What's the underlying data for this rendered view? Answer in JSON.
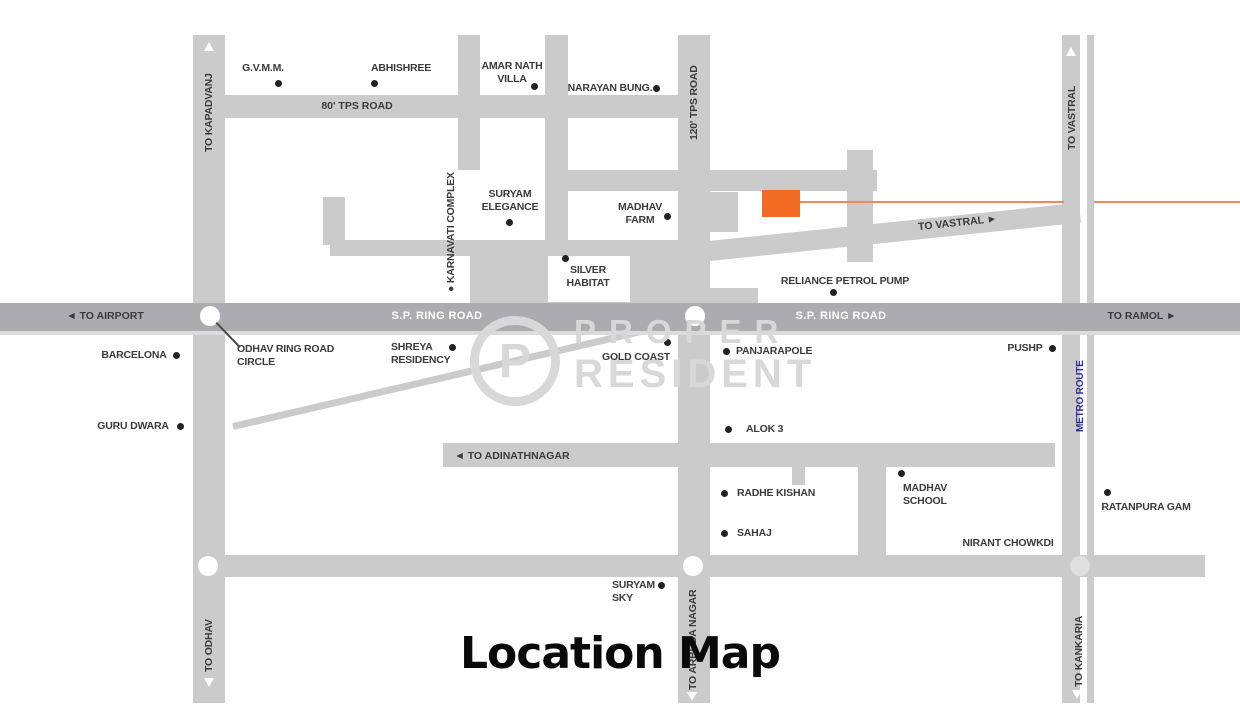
{
  "title": "Location Map",
  "watermark": {
    "logo": "P",
    "line1": "PROPER",
    "line2": "RESIDENT"
  },
  "colors": {
    "road": "#cbcbcb",
    "ring_road": "#acacb0",
    "marker_orange": "#f26b22",
    "line_orange": "#ee8a54",
    "metro_blue": "#2e3192",
    "label_dark": "#3b3b3b",
    "label_white": "#ffffff"
  },
  "road_labels": [
    {
      "id": "to-airport",
      "text": "◄ TO AIRPORT",
      "x": 105,
      "y": 316,
      "orient": "h",
      "color": "dark"
    },
    {
      "id": "sp-ring-road-left",
      "text": "S.P. RING ROAD",
      "x": 437,
      "y": 316,
      "orient": "h",
      "color": "white"
    },
    {
      "id": "sp-ring-road-right",
      "text": "S.P. RING ROAD",
      "x": 841,
      "y": 316,
      "orient": "h",
      "color": "white"
    },
    {
      "id": "to-ramol",
      "text": "TO RAMOL ►",
      "x": 1142,
      "y": 316,
      "orient": "h",
      "color": "dark"
    },
    {
      "id": "80-tps-road",
      "text": "80' TPS ROAD",
      "x": 357,
      "y": 106,
      "orient": "h",
      "color": "dark"
    },
    {
      "id": "to-adinathnagar",
      "text": "◄ TO ADINATHNAGAR",
      "x": 512,
      "y": 456,
      "orient": "h",
      "color": "dark"
    },
    {
      "id": "to-vastral-diag",
      "text": "TO VASTRAL ►",
      "x": 918,
      "y": 217,
      "orient": "d",
      "color": "dark"
    },
    {
      "id": "to-kapadvanj",
      "text": "TO KAPADVANJ",
      "x": 209,
      "y": 152,
      "orient": "v",
      "color": "dark"
    },
    {
      "id": "120-tps-road",
      "text": "120' TPS ROAD",
      "x": 694,
      "y": 140,
      "orient": "v",
      "color": "dark"
    },
    {
      "id": "to-vastral",
      "text": "TO VASTRAL",
      "x": 1072,
      "y": 150,
      "orient": "v",
      "color": "dark"
    },
    {
      "id": "karnavati-complex",
      "text": "● KARNAVATI COMPLEX",
      "x": 451,
      "y": 292,
      "orient": "v",
      "color": "dark"
    },
    {
      "id": "metro-route",
      "text": "METRO ROUTE",
      "x": 1081,
      "y": 432,
      "orient": "v",
      "color": "blue"
    },
    {
      "id": "to-odhav",
      "text": "TO ODHAV",
      "x": 209,
      "y": 672,
      "orient": "v",
      "color": "dark"
    },
    {
      "id": "to-arbuda-nagar",
      "text": "TO ARBUDA NAGAR",
      "x": 693,
      "y": 690,
      "orient": "v",
      "color": "dark"
    },
    {
      "id": "to-kankaria",
      "text": "TO KANKARIA",
      "x": 1079,
      "y": 687,
      "orient": "v",
      "color": "dark"
    }
  ],
  "places": [
    {
      "id": "gvmm",
      "lines": [
        "G.V.M.M."
      ],
      "x": 263,
      "y": 62,
      "align": "center",
      "dot": {
        "x": 278,
        "y": 83
      }
    },
    {
      "id": "abhishree",
      "lines": [
        "ABHISHREE"
      ],
      "x": 401,
      "y": 62,
      "align": "center",
      "dot": {
        "x": 374,
        "y": 83
      }
    },
    {
      "id": "amar-nath-villa",
      "lines": [
        "AMAR NATH",
        "VILLA"
      ],
      "x": 512,
      "y": 60,
      "align": "center",
      "dot": {
        "x": 534,
        "y": 86
      }
    },
    {
      "id": "narayan-bung",
      "lines": [
        "NARAYAN BUNG."
      ],
      "x": 610,
      "y": 82,
      "align": "center",
      "dot": {
        "x": 656,
        "y": 88
      }
    },
    {
      "id": "suryam-elegance",
      "lines": [
        "SURYAM",
        "ELEGANCE"
      ],
      "x": 510,
      "y": 188,
      "align": "center",
      "dot": {
        "x": 509,
        "y": 222
      }
    },
    {
      "id": "madhav-farm",
      "lines": [
        "MADHAV",
        "FARM"
      ],
      "x": 640,
      "y": 201,
      "align": "center",
      "dot": {
        "x": 667,
        "y": 216
      }
    },
    {
      "id": "silver-habitat",
      "lines": [
        "SILVER",
        "HABITAT"
      ],
      "x": 588,
      "y": 264,
      "align": "center",
      "dot": {
        "x": 565,
        "y": 258
      }
    },
    {
      "id": "reliance-petrol-pump",
      "lines": [
        "RELIANCE PETROL PUMP"
      ],
      "x": 845,
      "y": 275,
      "align": "center",
      "dot": {
        "x": 833,
        "y": 292
      }
    },
    {
      "id": "barcelona",
      "lines": [
        "BARCELONA"
      ],
      "x": 134,
      "y": 349,
      "align": "center",
      "dot": {
        "x": 176,
        "y": 355
      }
    },
    {
      "id": "odhav-ring-road-circle",
      "lines": [
        "ODHAV RING ROAD",
        "CIRCLE"
      ],
      "x": 237,
      "y": 343,
      "align": "left"
    },
    {
      "id": "shreya-residency",
      "lines": [
        "SHREYA",
        "RESIDENCY"
      ],
      "x": 391,
      "y": 341,
      "align": "left",
      "dot": {
        "x": 452,
        "y": 347
      }
    },
    {
      "id": "gold-coast",
      "lines": [
        "GOLD COAST"
      ],
      "x": 636,
      "y": 351,
      "align": "center",
      "dot": {
        "x": 667,
        "y": 342
      }
    },
    {
      "id": "panjarapole",
      "lines": [
        "PANJARAPOLE"
      ],
      "x": 736,
      "y": 345,
      "align": "left",
      "dot": {
        "x": 726,
        "y": 351
      }
    },
    {
      "id": "pushp",
      "lines": [
        "PUSHP"
      ],
      "x": 1025,
      "y": 342,
      "align": "center",
      "dot": {
        "x": 1052,
        "y": 348
      }
    },
    {
      "id": "guru-dwara",
      "lines": [
        "GURU DWARA"
      ],
      "x": 133,
      "y": 420,
      "align": "center",
      "dot": {
        "x": 180,
        "y": 426
      }
    },
    {
      "id": "alok-3",
      "lines": [
        "ALOK 3"
      ],
      "x": 746,
      "y": 423,
      "align": "left",
      "dot": {
        "x": 728,
        "y": 429
      }
    },
    {
      "id": "radhe-kishan",
      "lines": [
        "RADHE KISHAN"
      ],
      "x": 737,
      "y": 487,
      "align": "left",
      "dot": {
        "x": 724,
        "y": 493
      }
    },
    {
      "id": "sahaj",
      "lines": [
        "SAHAJ"
      ],
      "x": 737,
      "y": 527,
      "align": "left",
      "dot": {
        "x": 724,
        "y": 533
      }
    },
    {
      "id": "madhav-school",
      "lines": [
        "MADHAV",
        "SCHOOL"
      ],
      "x": 903,
      "y": 482,
      "align": "left",
      "dot": {
        "x": 901,
        "y": 473
      }
    },
    {
      "id": "nirant-chowkdi",
      "lines": [
        "NIRANT CHOWKDI"
      ],
      "x": 1008,
      "y": 537,
      "align": "center"
    },
    {
      "id": "ratanpura-gam",
      "lines": [
        "RATANPURA GAM"
      ],
      "x": 1146,
      "y": 501,
      "align": "center",
      "dot": {
        "x": 1107,
        "y": 492
      }
    },
    {
      "id": "suryam-sky",
      "lines": [
        "SURYAM",
        "SKY"
      ],
      "x": 612,
      "y": 579,
      "align": "left",
      "dot": {
        "x": 661,
        "y": 585
      }
    }
  ],
  "marker": {
    "rect": {
      "x": 762,
      "y": 190,
      "w": 38,
      "h": 27
    },
    "line_y": 201,
    "line_segments": [
      {
        "x1": 800,
        "x2": 1064
      },
      {
        "x1": 1094,
        "x2": 1240
      }
    ]
  }
}
